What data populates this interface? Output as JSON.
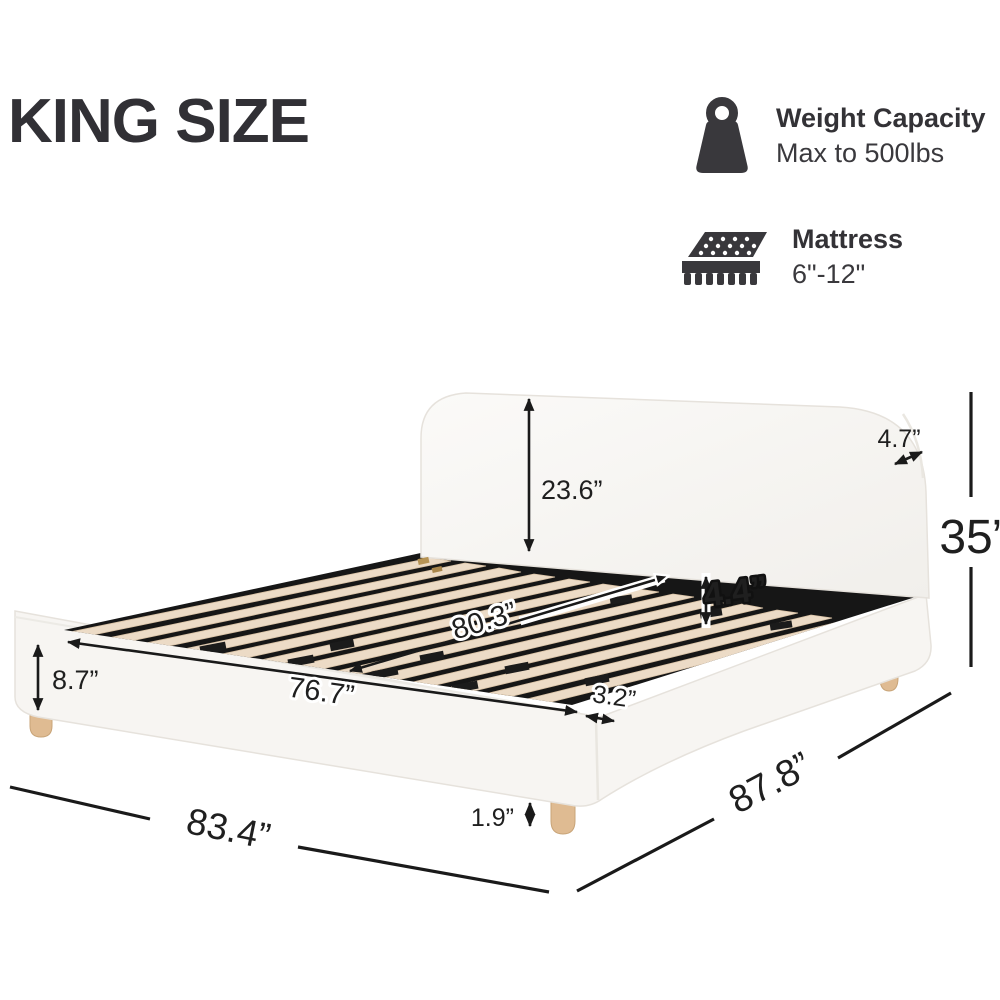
{
  "title": "KING SIZE",
  "features": [
    {
      "icon": "weight-icon",
      "label": "Weight Capacity",
      "value": "Max to 500lbs"
    },
    {
      "icon": "mattress-icon",
      "label": "Mattress",
      "value": "6\"-12\""
    }
  ],
  "dimensions": {
    "headboard_height": "23.6”",
    "headboard_top_thickness": "4.7”",
    "overall_height": "35”",
    "rail_to_slat_depth": "4.4”",
    "slat_length": "80.3”",
    "inner_width": "76.7”",
    "side_rail_height": "8.7”",
    "rail_edge_thickness": "3.2”",
    "leg_height": "1.9”",
    "overall_width": "83.4”",
    "overall_length": "87.8”"
  },
  "colors": {
    "ink": "#1f1f1f",
    "fabric": "#f7f5f2",
    "deck": "#161616",
    "slat": "#ecdbc6",
    "leg_wood": "#dfbb92"
  }
}
